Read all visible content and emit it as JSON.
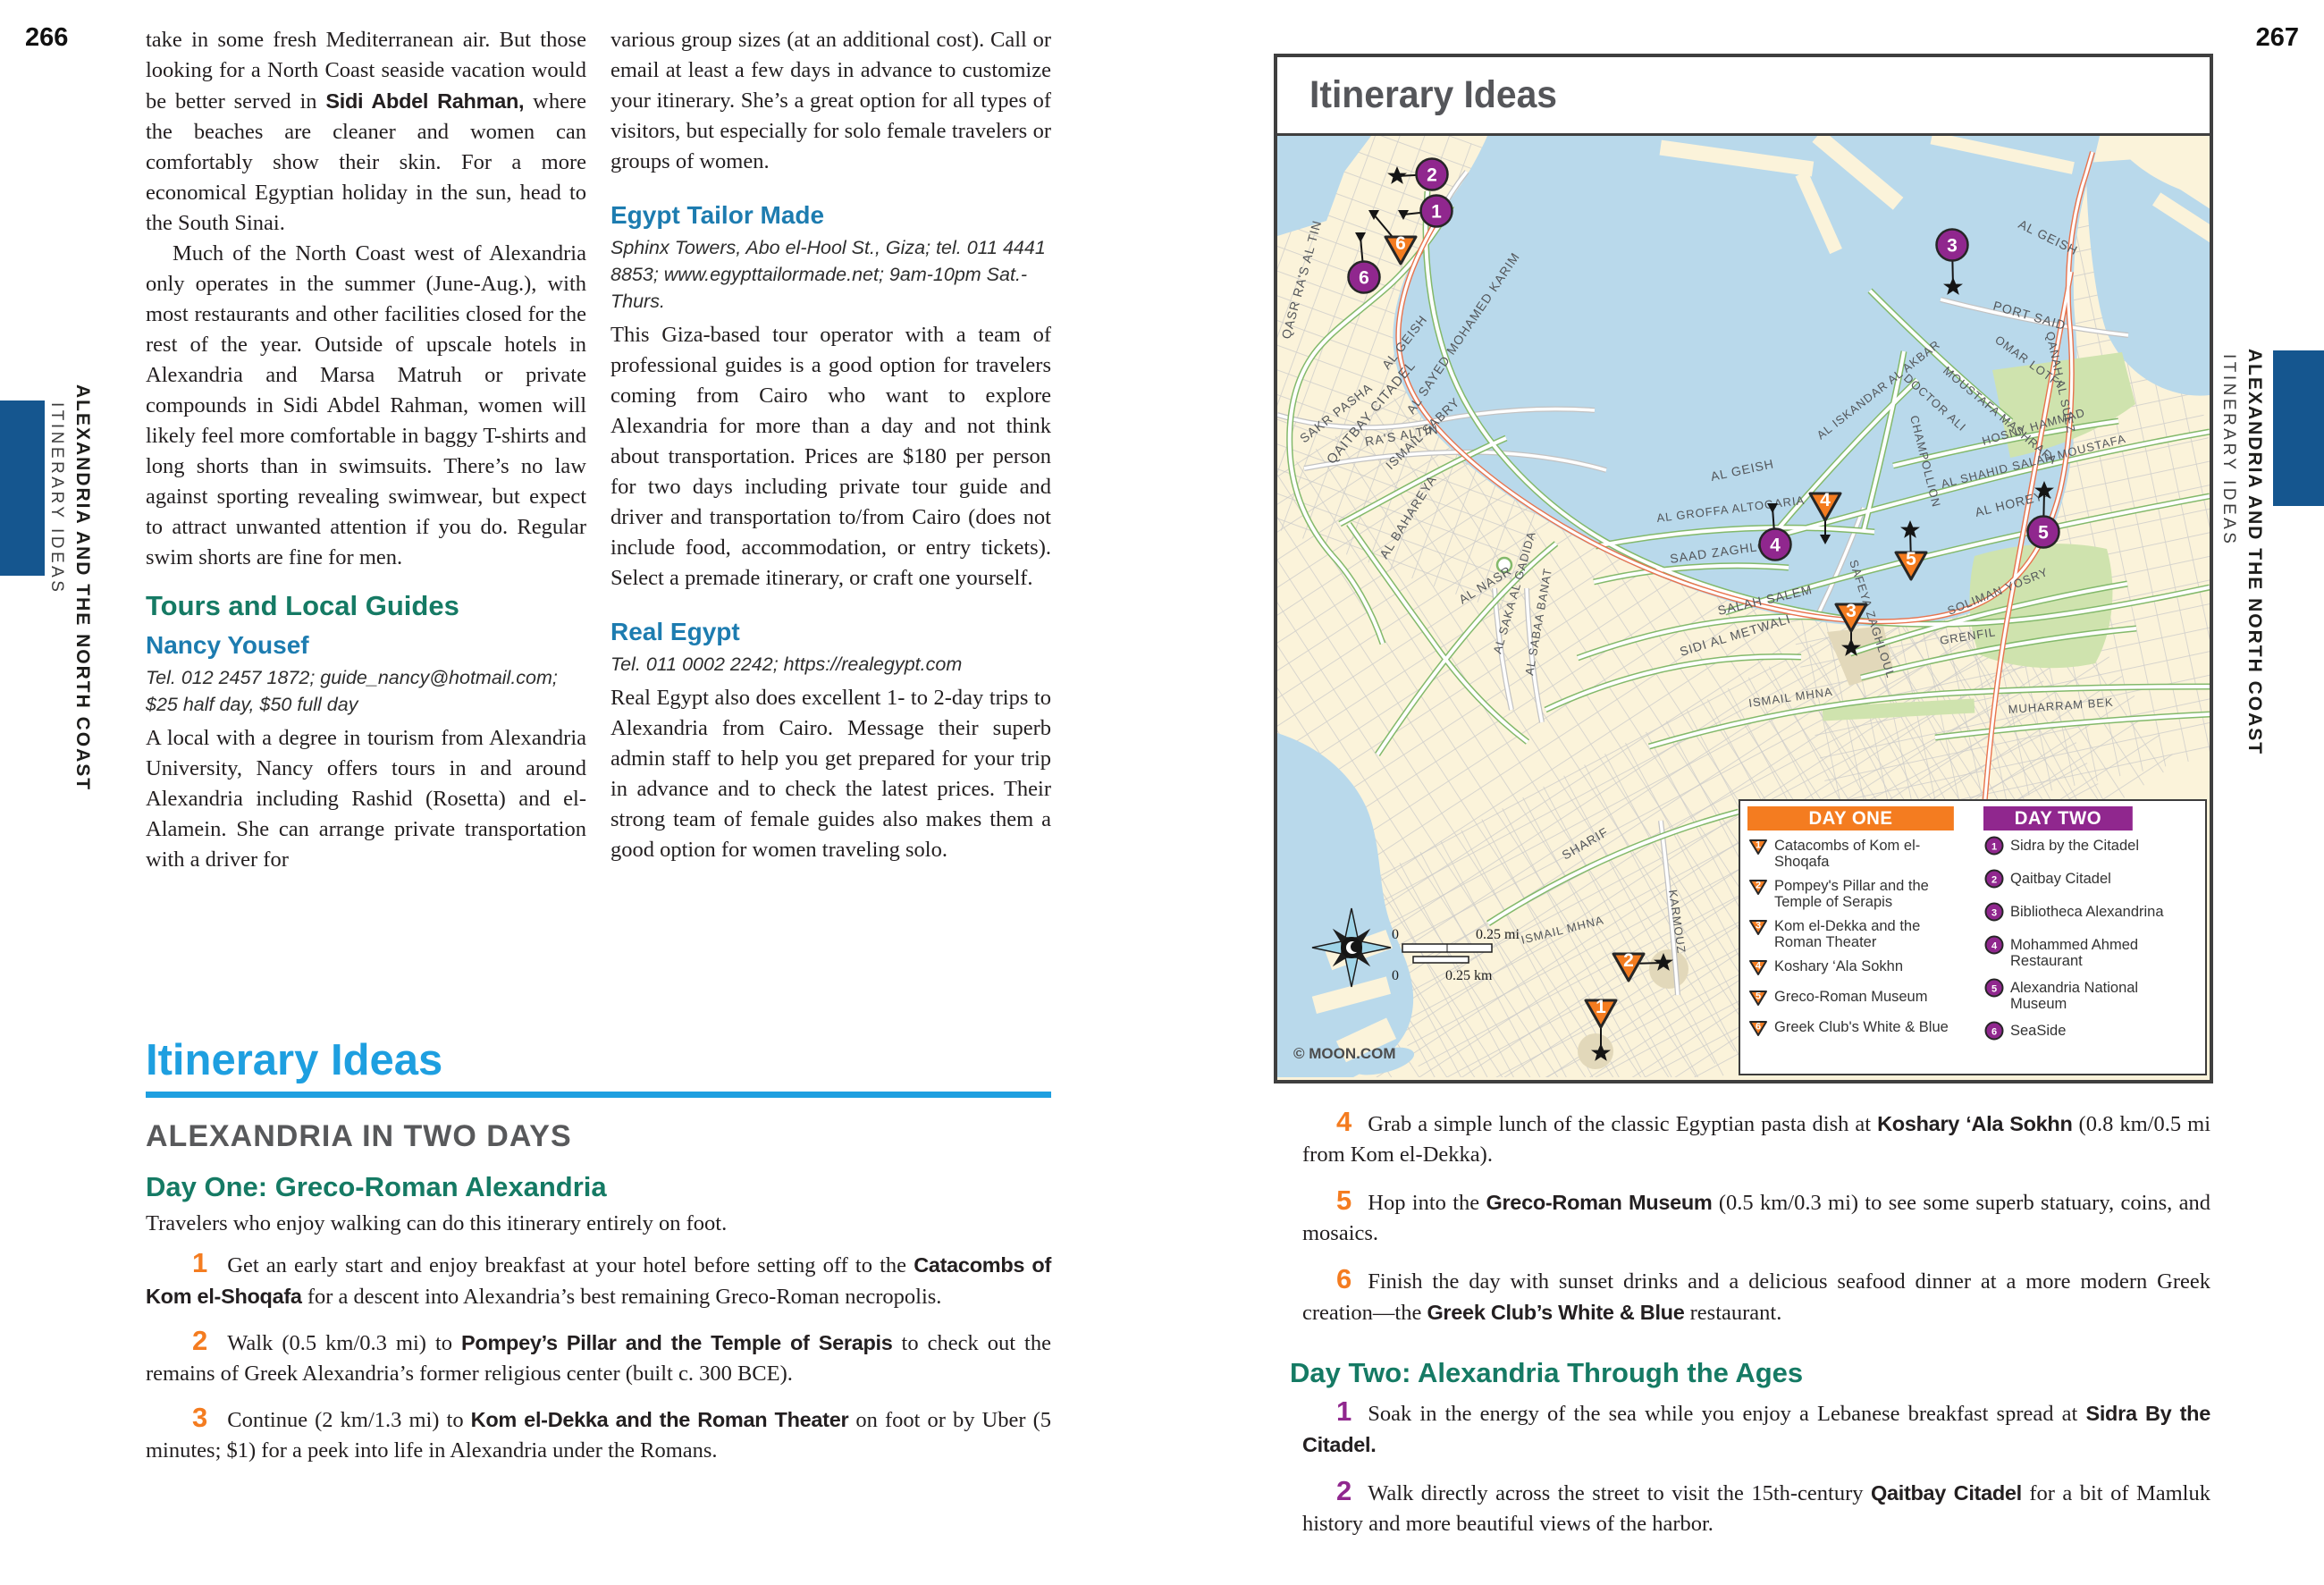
{
  "page_left": {
    "number": "266",
    "margin": {
      "series": "ALEXANDRIA AND THE NORTH COAST",
      "section": "ITINERARY IDEAS"
    },
    "col1": {
      "p1": [
        "take in some fresh Mediterranean air. But those looking for a North Coast seaside vacation would be better served in ",
        {
          "b": "Sidi Abdel Rahman,"
        },
        " where the beaches are cleaner and women can comfortably show their skin. For a more economical Egyptian holiday in the sun, head to the South Sinai."
      ],
      "p2": "Much of the North Coast west of Alexandria only operates in the summer (June-Aug.), with most restaurants and other facilities closed for the rest of the year. Outside of upscale hotels in Alexandria and Marsa Matruh or private compounds in Sidi Abdel Rahman, women will likely feel more comfortable in baggy T-shirts and long shorts than in swimsuits. There’s no law against sporting revealing swimwear, but expect to attract unwanted attention if you do. Regular swim shorts are fine for men.",
      "tours_heading": "Tours and Local Guides",
      "nancy_heading": "Nancy Yousef",
      "nancy_contact": "Tel. 012 2457 1872; guide_nancy@hotmail.com; $25 half day, $50 full day",
      "p3": "A local with a degree in tourism from Alexandria University, Nancy offers tours in and around Alexandria including Rashid (Rosetta) and el-Alamein. She can arrange private transportation with a driver for"
    },
    "col2": {
      "p1": "various group sizes (at an additional cost). Call or email at least a few days in advance to customize your itinerary. She’s a great option for all types of visitors, but especially for solo female travelers or groups of women.",
      "etm_heading": "Egypt Tailor Made",
      "etm_contact": "Sphinx Towers, Abo el-Hool St., Giza; tel. 011 4441 8853; www.egypttailormade.net; 9am-10pm Sat.-Thurs.",
      "p2": "This Giza-based tour operator with a team of professional guides is a good option for travelers coming from Cairo who want to explore Alexandria for more than a day and not think about transportation. Prices are $180 per person for two days including private tour guide and driver and transportation to/from Cairo (does not include food, accommodation, or entry tickets). Select a premade itinerary, or craft one yourself.",
      "real_heading": "Real Egypt",
      "real_contact": "Tel. 011 0002 2242; https://realegypt.com",
      "p3": "Real Egypt also does excellent 1- to 2-day trips to Alexandria from Cairo. Message their superb admin staff to help you get prepared for your trip in advance and to check the latest prices. Their strong team of female guides also makes them a good option for women traveling solo."
    },
    "itinerary": {
      "title": "Itinerary Ideas",
      "subtitle": "ALEXANDRIA IN TWO DAYS",
      "day1_heading": "Day One: Greco-Roman Alexandria",
      "day1_intro": "Travelers who enjoy walking can do this itinerary entirely on foot.",
      "steps": [
        {
          "n": "1",
          "seg": [
            "Get an early start and enjoy breakfast at your hotel before setting off to the ",
            {
              "b": "Catacombs of Kom el-Shoqafa"
            },
            " for a descent into Alexandria’s best remaining Greco-Roman necropolis."
          ]
        },
        {
          "n": "2",
          "seg": [
            "Walk (0.5 km/0.3 mi) to ",
            {
              "b": "Pompey’s Pillar and the Temple of Serapis"
            },
            " to check out the remains of Greek Alexandria’s former religious center (built c. 300 BCE)."
          ]
        },
        {
          "n": "3",
          "seg": [
            "Continue (2 km/1.3 mi) to ",
            {
              "b": "Kom el-Dekka and the Roman Theater"
            },
            " on foot or by Uber (5 minutes; $1) for a peek into life in Alexandria under the Romans."
          ]
        }
      ]
    }
  },
  "page_right": {
    "number": "267",
    "margin": {
      "series": "ALEXANDRIA AND THE NORTH COAST",
      "section": "ITINERARY IDEAS"
    },
    "steps_day1": [
      {
        "n": "4",
        "seg": [
          "Grab a simple lunch of the classic Egyptian pasta dish at ",
          {
            "b": "Koshary ‘Ala Sokhn"
          },
          " (0.8 km/0.5 mi from Kom el-Dekka)."
        ]
      },
      {
        "n": "5",
        "seg": [
          "Hop into the ",
          {
            "b": "Greco-Roman Museum"
          },
          " (0.5 km/0.3 mi) to see some superb statuary, coins, and mosaics."
        ]
      },
      {
        "n": "6",
        "seg": [
          "Finish the day with sunset drinks and a delicious seafood dinner at a more modern Greek creation—the ",
          {
            "b": "Greek Club’s White & Blue"
          },
          " restaurant."
        ]
      }
    ],
    "day2_heading": "Day Two: Alexandria Through the Ages",
    "steps_day2": [
      {
        "n": "1",
        "seg": [
          "Soak in the energy of the sea while you enjoy a Lebanese breakfast spread at ",
          {
            "b": "Sidra By the Citadel."
          }
        ]
      },
      {
        "n": "2",
        "seg": [
          "Walk directly across the street to visit the 15th-century ",
          {
            "b": "Qaitbay Citadel"
          },
          " for a bit of Mamluk history and more beautiful views of the harbor."
        ]
      }
    ]
  },
  "map": {
    "title": "Itinerary Ideas",
    "copyright": "© MOON.COM",
    "scale": {
      "mi0": "0",
      "mi": "0.25 mi",
      "km0": "0",
      "km": "0.25 km"
    },
    "colors": {
      "day_one": "#f47c20",
      "day_two": "#90278e",
      "water": "#b9d9eb",
      "land": "#fbf3da",
      "park": "#cfe3ae"
    },
    "legend": {
      "day_one": {
        "label": "DAY ONE",
        "marker": "triangle",
        "items": [
          "Catacombs of Kom el-Shoqafa",
          "Pompey's Pillar and the Temple of Serapis",
          "Kom el-Dekka and the Roman Theater",
          "Koshary ‘Ala Sokhn",
          "Greco-Roman Museum",
          "Greek Club's White & Blue"
        ]
      },
      "day_two": {
        "label": "DAY TWO",
        "marker": "circle",
        "items": [
          "Sidra by the Citadel",
          "Qaitbay Citadel",
          "Bibliotheca Alexandrina",
          "Mohammed Ahmed Restaurant",
          "Alexandria National Museum",
          "SeaSide"
        ]
      }
    },
    "street_labels": [
      {
        "t": "QAITBAY CITADEL",
        "x": 62,
        "y": 368,
        "r": -50,
        "s": 15
      },
      {
        "t": "QASR RA'S AL TIN",
        "x": 14,
        "y": 228,
        "r": -75,
        "s": 14
      },
      {
        "t": "AL GEISH",
        "x": 124,
        "y": 262,
        "r": -52,
        "s": 14
      },
      {
        "t": "AL SAYED MOHAMED KARIM",
        "x": 152,
        "y": 312,
        "r": -56,
        "s": 14
      },
      {
        "t": "SAKR PASHA",
        "x": 30,
        "y": 344,
        "r": -38,
        "s": 14
      },
      {
        "t": "RA'S ALTIN",
        "x": 99,
        "y": 347,
        "r": -10,
        "s": 14
      },
      {
        "t": "ISMAIL SABRY",
        "x": 127,
        "y": 374,
        "r": -44,
        "s": 14
      },
      {
        "t": "AL BAHAREYA",
        "x": 122,
        "y": 474,
        "r": -58,
        "s": 14
      },
      {
        "t": "AL NASR",
        "x": 207,
        "y": 524,
        "r": -32,
        "s": 14
      },
      {
        "t": "AL SAKA AL GADIDA",
        "x": 250,
        "y": 580,
        "r": -74,
        "s": 13
      },
      {
        "t": "AL SABAA BANAT",
        "x": 286,
        "y": 604,
        "r": -80,
        "s": 13
      },
      {
        "t": "SIDI AL METWALI",
        "x": 452,
        "y": 582,
        "r": -17,
        "s": 14
      },
      {
        "t": "SALAH SALEM",
        "x": 494,
        "y": 536,
        "r": -13,
        "s": 14
      },
      {
        "t": "SAAD ZAGHLOUL",
        "x": 440,
        "y": 478,
        "r": -8,
        "s": 14
      },
      {
        "t": "AL GROFFA ALTOGARIA",
        "x": 425,
        "y": 432,
        "r": -7,
        "s": 13
      },
      {
        "t": "AL GEISH",
        "x": 486,
        "y": 386,
        "r": -12,
        "s": 14
      },
      {
        "t": "AL ISKANDAR AL AKBAR",
        "x": 608,
        "y": 340,
        "r": -38,
        "s": 13
      },
      {
        "t": "SAFEYA ZAGHLOUL",
        "x": 640,
        "y": 476,
        "r": 72,
        "s": 13
      },
      {
        "t": "CHAMPOLLION",
        "x": 708,
        "y": 314,
        "r": 76,
        "s": 13
      },
      {
        "t": "DOCTOR ALI",
        "x": 700,
        "y": 272,
        "r": 42,
        "s": 13
      },
      {
        "t": "MOUSTAFA MASHRAFA",
        "x": 744,
        "y": 264,
        "r": 40,
        "s": 13
      },
      {
        "t": "OMAR LOTFI",
        "x": 802,
        "y": 230,
        "r": 36,
        "s": 13
      },
      {
        "t": "PORT SAID",
        "x": 800,
        "y": 194,
        "r": 16,
        "s": 14
      },
      {
        "t": "QANAH AL SUEZ",
        "x": 860,
        "y": 220,
        "r": 78,
        "s": 13
      },
      {
        "t": "AL GEISH",
        "x": 828,
        "y": 102,
        "r": 26,
        "s": 14
      },
      {
        "t": "HOSNY HAMMAD",
        "x": 790,
        "y": 346,
        "r": -16,
        "s": 13
      },
      {
        "t": "AL SHAHID SALAH MOUSTAFA",
        "x": 744,
        "y": 394,
        "r": -14,
        "s": 13
      },
      {
        "t": "AL HOREYA",
        "x": 782,
        "y": 426,
        "r": -14,
        "s": 14
      },
      {
        "t": "SOLIMAN YOSRY",
        "x": 752,
        "y": 536,
        "r": -22,
        "s": 13
      },
      {
        "t": "GRENFIL",
        "x": 742,
        "y": 569,
        "r": -9,
        "s": 13
      },
      {
        "t": "ISMAIL MHNA",
        "x": 528,
        "y": 639,
        "r": -8,
        "s": 13
      },
      {
        "t": "MUHARRAM BEK",
        "x": 818,
        "y": 646,
        "r": -4,
        "s": 13
      },
      {
        "t": "ISMAIL MHNA",
        "x": 274,
        "y": 904,
        "r": -14,
        "s": 13
      },
      {
        "t": "SHARIF",
        "x": 322,
        "y": 810,
        "r": -30,
        "s": 14
      },
      {
        "t": "KARMOUZ",
        "x": 438,
        "y": 844,
        "r": 82,
        "s": 13
      }
    ],
    "markers": [
      {
        "t": "p",
        "n": "2",
        "x": 173,
        "y": 43,
        "a": "star",
        "ax": 134,
        "ay": 45
      },
      {
        "t": "p",
        "n": "1",
        "x": 178,
        "y": 84,
        "a": "tri",
        "ax": 141,
        "ay": 88
      },
      {
        "t": "o",
        "n": "6",
        "x": 138,
        "y": 124,
        "a": "tri",
        "ax": 108,
        "ay": 88
      },
      {
        "t": "p",
        "n": "6",
        "x": 97,
        "y": 158,
        "a": "tri",
        "ax": 93,
        "ay": 113
      },
      {
        "t": "p",
        "n": "3",
        "x": 755,
        "y": 122,
        "a": "star",
        "ax": 756,
        "ay": 169
      },
      {
        "t": "o",
        "n": "4",
        "x": 613,
        "y": 411,
        "a": "tri",
        "ax": 613,
        "ay": 451
      },
      {
        "t": "p",
        "n": "4",
        "x": 557,
        "y": 457,
        "a": "tri",
        "ax": 554,
        "ay": 416
      },
      {
        "t": "o",
        "n": "5",
        "x": 709,
        "y": 477,
        "a": "star",
        "ax": 708,
        "ay": 441
      },
      {
        "t": "p",
        "n": "5",
        "x": 857,
        "y": 443,
        "a": "star",
        "ax": 858,
        "ay": 397
      },
      {
        "t": "o",
        "n": "3",
        "x": 642,
        "y": 535,
        "a": "star",
        "ax": 642,
        "ay": 573
      },
      {
        "t": "o",
        "n": "2",
        "x": 393,
        "y": 926,
        "a": "star",
        "ax": 432,
        "ay": 925
      },
      {
        "t": "o",
        "n": "1",
        "x": 362,
        "y": 978,
        "a": "star",
        "ax": 362,
        "ay": 1026
      }
    ]
  }
}
